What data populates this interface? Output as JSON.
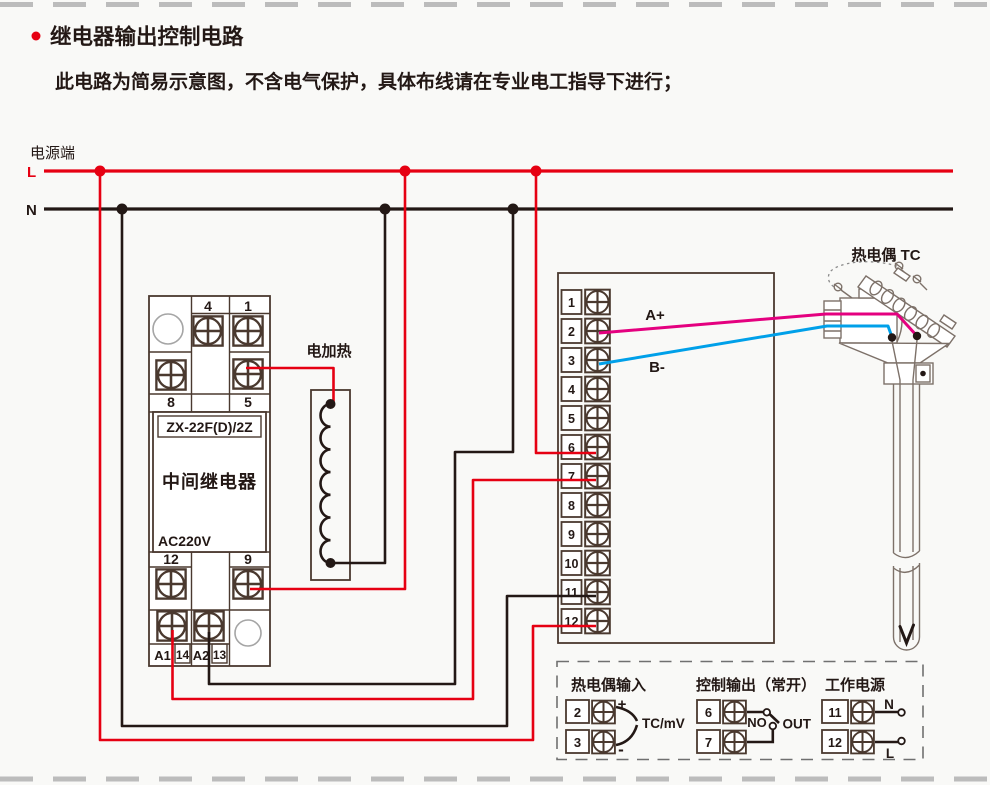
{
  "page": {
    "title": "继电器输出控制电路",
    "subtitle": "此电路为简易示意图，不含电气保护，具体布线请在专业电工指导下进行；",
    "power_side": "电源端",
    "l_label": "L",
    "n_label": "N"
  },
  "relay": {
    "model": "ZX-22F(D)/2Z",
    "name": "中间继电器",
    "voltage": "AC220V",
    "t4": "4",
    "t1": "1",
    "t8": "8",
    "t5": "5",
    "t12": "12",
    "t9": "9",
    "a1": "A1",
    "t14": "14",
    "a2": "A2",
    "t13": "13"
  },
  "heater": {
    "label": "电加热"
  },
  "controller": {
    "terminals": [
      "1",
      "2",
      "3",
      "4",
      "5",
      "6",
      "7",
      "8",
      "9",
      "10",
      "11",
      "12"
    ],
    "a_plus": "A+",
    "b_minus": "B-"
  },
  "thermocouple": {
    "label": "热电偶 TC"
  },
  "legend": {
    "tc_input": {
      "title": "热电偶输入",
      "t2": "2",
      "t3": "3",
      "plus": "+",
      "minus": "-",
      "unit": "TC/mV"
    },
    "control_output": {
      "title": "控制输出（常开）",
      "t6": "6",
      "t7": "7",
      "no_label": "NO",
      "out_label": "OUT"
    },
    "power": {
      "title": "工作电源",
      "t11": "11",
      "t12": "12",
      "n": "N",
      "l": "L"
    }
  },
  "colors": {
    "wire_live_red": "#e60012",
    "wire_neutral_black": "#231815",
    "tc_positive_pink": "#e4007f",
    "tc_negative_blue": "#00a0e9"
  }
}
